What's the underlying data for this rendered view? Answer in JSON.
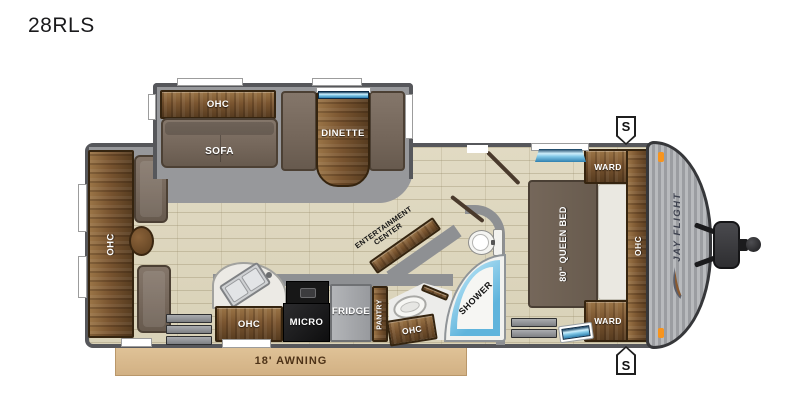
{
  "title": "28RLS",
  "labels": {
    "rear_ohc": "OHC",
    "sofa_ohc": "OHC",
    "sofa": "SOFA",
    "dinette": "DINETTE",
    "entertainment_line1": "ENTERTAINMENT",
    "entertainment_line2": "CENTER",
    "kitchen_ohc": "OHC",
    "micro": "MICRO",
    "fridge": "FRIDGE",
    "pantry": "PANTRY",
    "bath_ohc": "OHC",
    "shower": "SHOWER",
    "queen_bed": "80\" QUEEN BED",
    "ward_top": "WARD",
    "ward_bottom": "WARD",
    "front_ohc": "OHC",
    "brand_logo": "JAY FLIGHT",
    "awning": "18' AWNING",
    "speaker_top": "S",
    "speaker_bottom": "S"
  },
  "colors": {
    "wall_gray": "#56575b",
    "slide_floor_gray": "#97989b",
    "floor_tan": "#dcd5bc",
    "wood_dark": "#573c20",
    "wood_light": "#9a7446",
    "upholstery": "#74665a",
    "awning_tan": "#d9ba8c",
    "window_blue": "#2e7fae",
    "shower_blue": "#5fb4dc",
    "marker_orange": "#f7941d"
  }
}
